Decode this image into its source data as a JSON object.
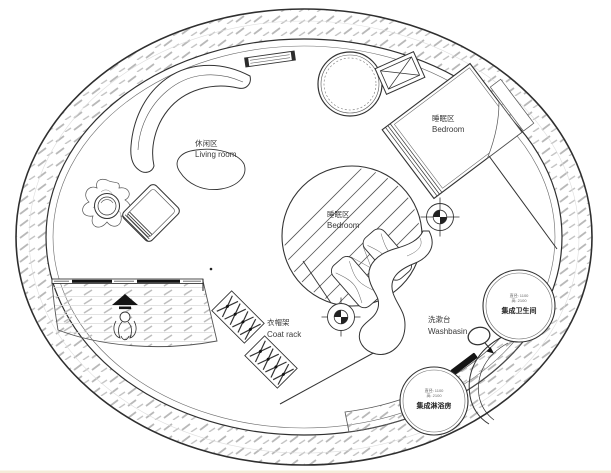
{
  "plan": {
    "title": "circular-house-floor-plan",
    "living_room": {
      "label_zh": "休闲区",
      "label_en": "Living room"
    },
    "bedroom_upper": {
      "label_zh": "睡眠区",
      "label_en": "Bedroom"
    },
    "bedroom_center": {
      "label_zh": "睡眠区",
      "label_en": "Bedroom"
    },
    "coat_rack": {
      "label_zh": "衣帽架",
      "label_en": "Coat rack"
    },
    "washbasin": {
      "label_zh": "洗漱台",
      "label_en": "Washbasin"
    },
    "bathroom_pod": {
      "dim_line1": "直径: 1100",
      "dim_line2": "高: 2100",
      "label_zh": "集成卫生间"
    },
    "shower_pod": {
      "dim_line1": "直径: 1100",
      "dim_line2": "高: 2100",
      "label_zh": "集成淋浴房"
    },
    "colors": {
      "line": "#333333",
      "hatch": "#b9b9b9",
      "background": "#ffffff",
      "black_fill": "#141414"
    }
  }
}
